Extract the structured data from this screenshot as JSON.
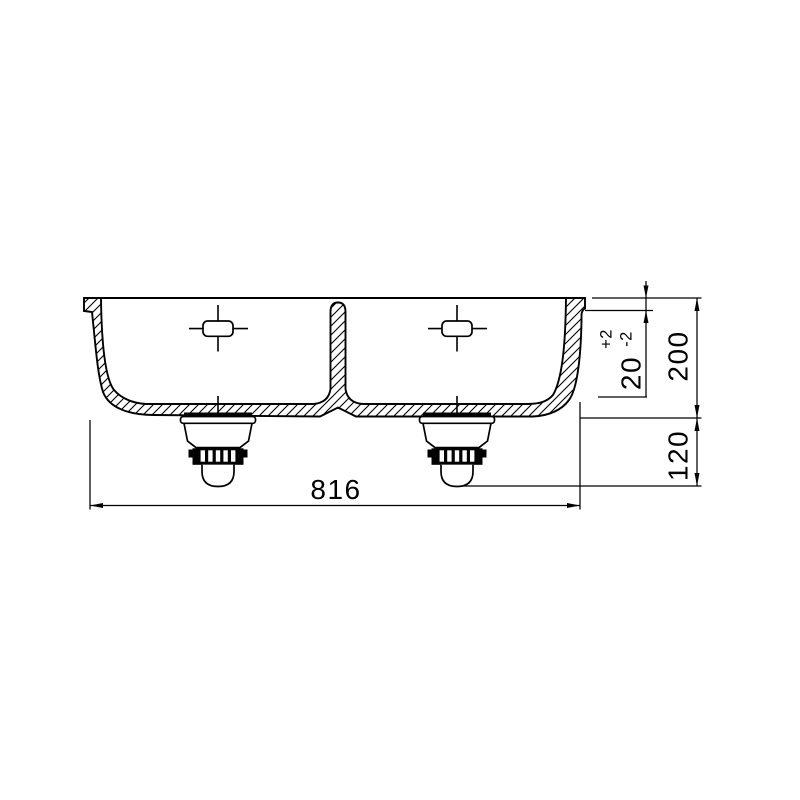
{
  "drawing": {
    "title": "double-bowl-sink-cross-section",
    "background_color": "#ffffff",
    "line_color": "#000000",
    "dims": {
      "overall_width": "816",
      "depth_total": "200",
      "drain_height": "120",
      "rim_step": "20",
      "rim_tol_plus": "+2",
      "rim_tol_minus": "-2"
    }
  }
}
